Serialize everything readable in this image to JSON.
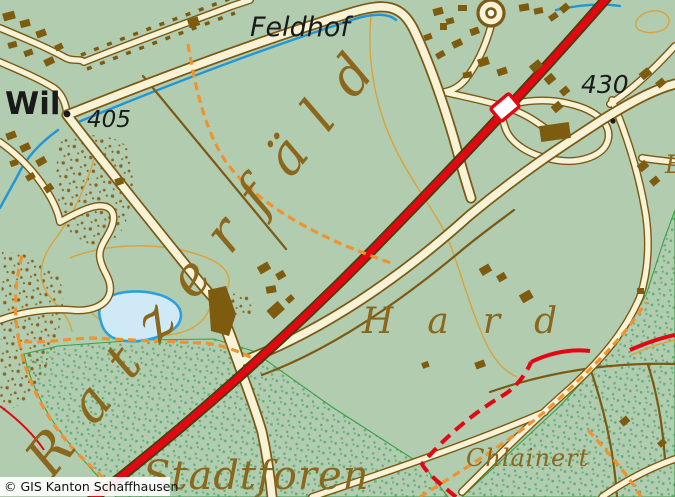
{
  "map": {
    "settlement_labels": [
      {
        "id": "wil",
        "text": "Wil"
      }
    ],
    "farm_labels": [
      {
        "id": "feldhof",
        "text": "Feldhof"
      }
    ],
    "spot_heights": [
      {
        "id": "h405",
        "text": "405"
      },
      {
        "id": "h430",
        "text": "430"
      }
    ],
    "field_names": {
      "large_diagonal": "Ratzerfäld",
      "hard": "Hard",
      "stadtforen": "Stadtforen",
      "chlainert": "Chlainert",
      "partial_east": "E"
    },
    "symbols": {
      "roundabout": "roundabout",
      "level_crossing_marker": "white box on main road",
      "spot_height_dots": 2
    }
  },
  "attribution": {
    "text": "© GIS Kanton Schaffhausen"
  },
  "colors": {
    "background": "#b2ccb0",
    "forest_dot": "#22995299",
    "orchard_dot": "#8a6420",
    "forest_edge": "#3aa143",
    "road_fill": "#f8f2d7",
    "road_casing": "#7a5a14",
    "main_road": "#e30613",
    "main_road_casing": "#4c3d0a",
    "building": "#7d5c10",
    "water_fill": "#cfe9f6",
    "water_stroke": "#2da0dc",
    "stream": "#2196d6",
    "contour": "#d8a33c",
    "path_orange": "#f0922e",
    "hiking_red": "#e30613",
    "label_black": "#1a1a1a",
    "label_brown": "#8a671c"
  }
}
